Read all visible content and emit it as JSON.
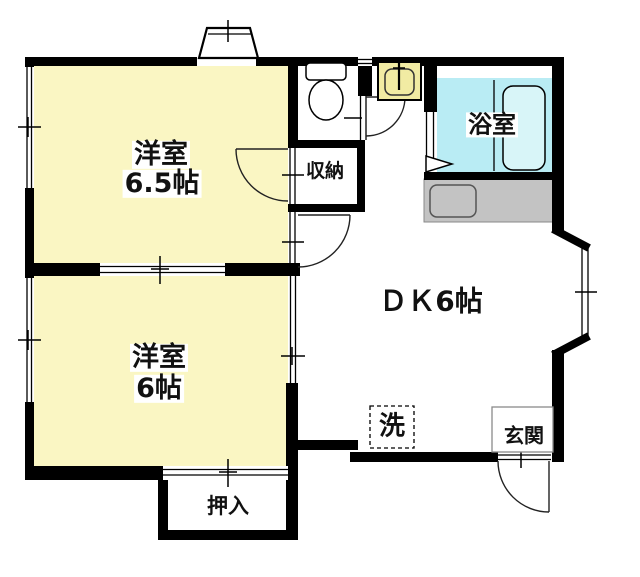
{
  "floorplan": {
    "type": "apartment-floor-plan",
    "rooms": {
      "western1": {
        "name": "洋室",
        "size": "6.5帖"
      },
      "western2": {
        "name": "洋室",
        "size": "6帖"
      },
      "dk": {
        "label": "ＤＫ6帖"
      },
      "bath": {
        "label": "浴室"
      },
      "storage": {
        "label": "収納"
      },
      "closet": {
        "label": "押入"
      },
      "entrance": {
        "label": "玄関"
      },
      "laundry": {
        "label": "洗"
      }
    },
    "colors": {
      "room_fill": "#FAF6C3",
      "bath_fill": "#B9ECF4",
      "tub_fill": "#D8F5F8",
      "counter_fill": "#C3C3C3",
      "basin_fill": "#F1EBA3",
      "wall": "#000000"
    }
  }
}
